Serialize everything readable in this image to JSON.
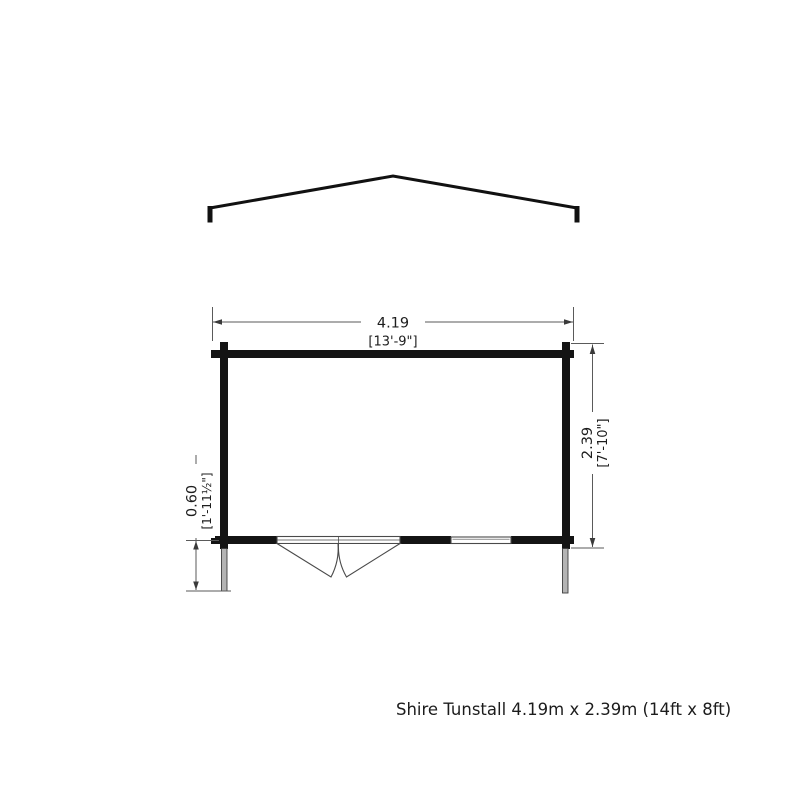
{
  "diagram": {
    "caption": "Shire Tunstall 4.19m x 2.39m (14ft x 8ft)",
    "dimensions": {
      "width": {
        "metric": "4.19",
        "imperial": "[13'-9\"]"
      },
      "depth": {
        "metric": "2.39",
        "imperial": "[7'-10\"]"
      },
      "overhang": {
        "metric": "0.60",
        "imperial": "[1'-11½\"]"
      }
    },
    "colors": {
      "wall": "#141414",
      "dimension_line": "#5a5a5a",
      "text": "#1d1d1d",
      "post_fill": "#b4b4b4",
      "background": "#ffffff"
    }
  }
}
